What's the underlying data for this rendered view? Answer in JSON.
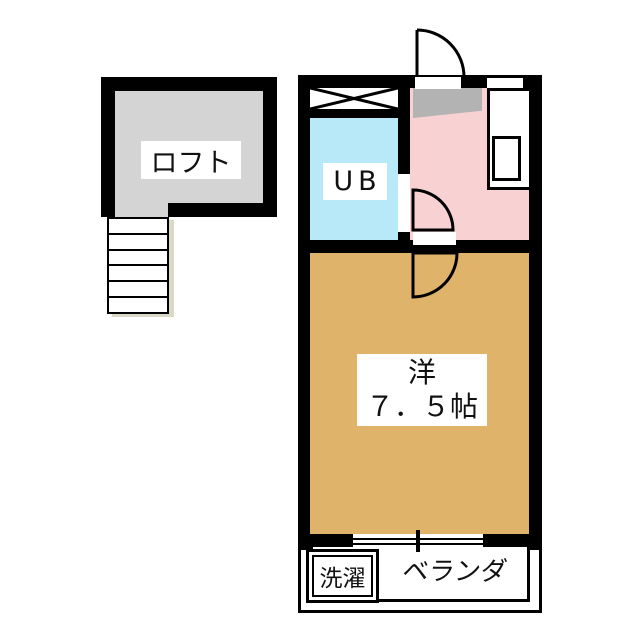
{
  "document": {
    "type": "floor-plan",
    "language": "ja"
  },
  "rooms": {
    "loft": {
      "label": "ロフト"
    },
    "unit_bath": {
      "label": "UB"
    },
    "main_room": {
      "label_line1": "洋",
      "label_line2": "７．５帖"
    },
    "veranda": {
      "label": "ベランダ"
    },
    "laundry": {
      "label": "洗濯"
    }
  },
  "fixtures": [
    "stairs",
    "closet-crossbox",
    "entrance-door",
    "unit-bath-door",
    "main-room-door",
    "kitchen-counter",
    "kitchen-sink",
    "kitchen-window",
    "sliding-window",
    "entry-step-area"
  ],
  "colors": {
    "wall": "#000000",
    "loft_fill": "#d4d4d4",
    "entry_fill": "#f8d2d2",
    "genkan_fill": "#b3b3b3",
    "ub_fill": "#b7e9f8",
    "room_fill": "#dfb36a",
    "outline_beige": "#d9d9c6",
    "background": "#ffffff"
  }
}
